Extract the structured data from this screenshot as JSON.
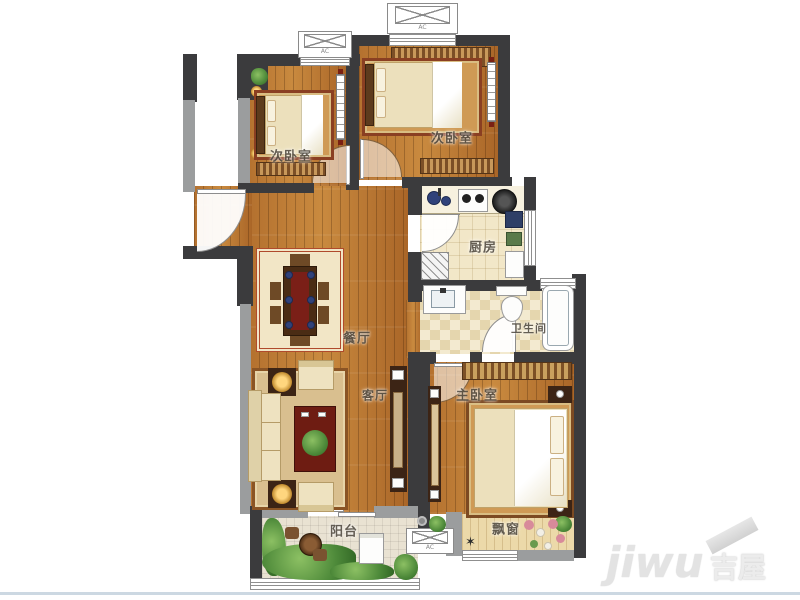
{
  "plan": {
    "type": "apartment-floor-plan",
    "rooms": {
      "bedroom_left": {
        "label": "次卧室"
      },
      "bedroom_right": {
        "label": "次卧室"
      },
      "kitchen": {
        "label": "厨房"
      },
      "bathroom": {
        "label": "卫生间"
      },
      "dining": {
        "label": "餐厅"
      },
      "living": {
        "label": "客厅"
      },
      "master_bedroom": {
        "label": "主卧室"
      },
      "balcony": {
        "label": "阳台"
      },
      "bay_window": {
        "label": "飘窗"
      }
    },
    "annotations": {
      "ac_platform_label": "AC"
    }
  },
  "watermark": {
    "brand_latin": "jiwu",
    "brand_cjk": "吉屋"
  },
  "colors": {
    "wall_dark": "#3b3b3d",
    "wall_gray": "#9b9d9e",
    "wood": "#b4712f",
    "wood_light": "#ecd9a9",
    "tile_kitchen": "#f2e7c8",
    "tile_balcony": "#e9e2d2",
    "accent_red": "#7a1f17",
    "plant_green": "#4e8a3a",
    "water_blue": "#30427a",
    "divider_blue": "#ccd8e2",
    "watermark_gray": "#e3e3e3"
  }
}
